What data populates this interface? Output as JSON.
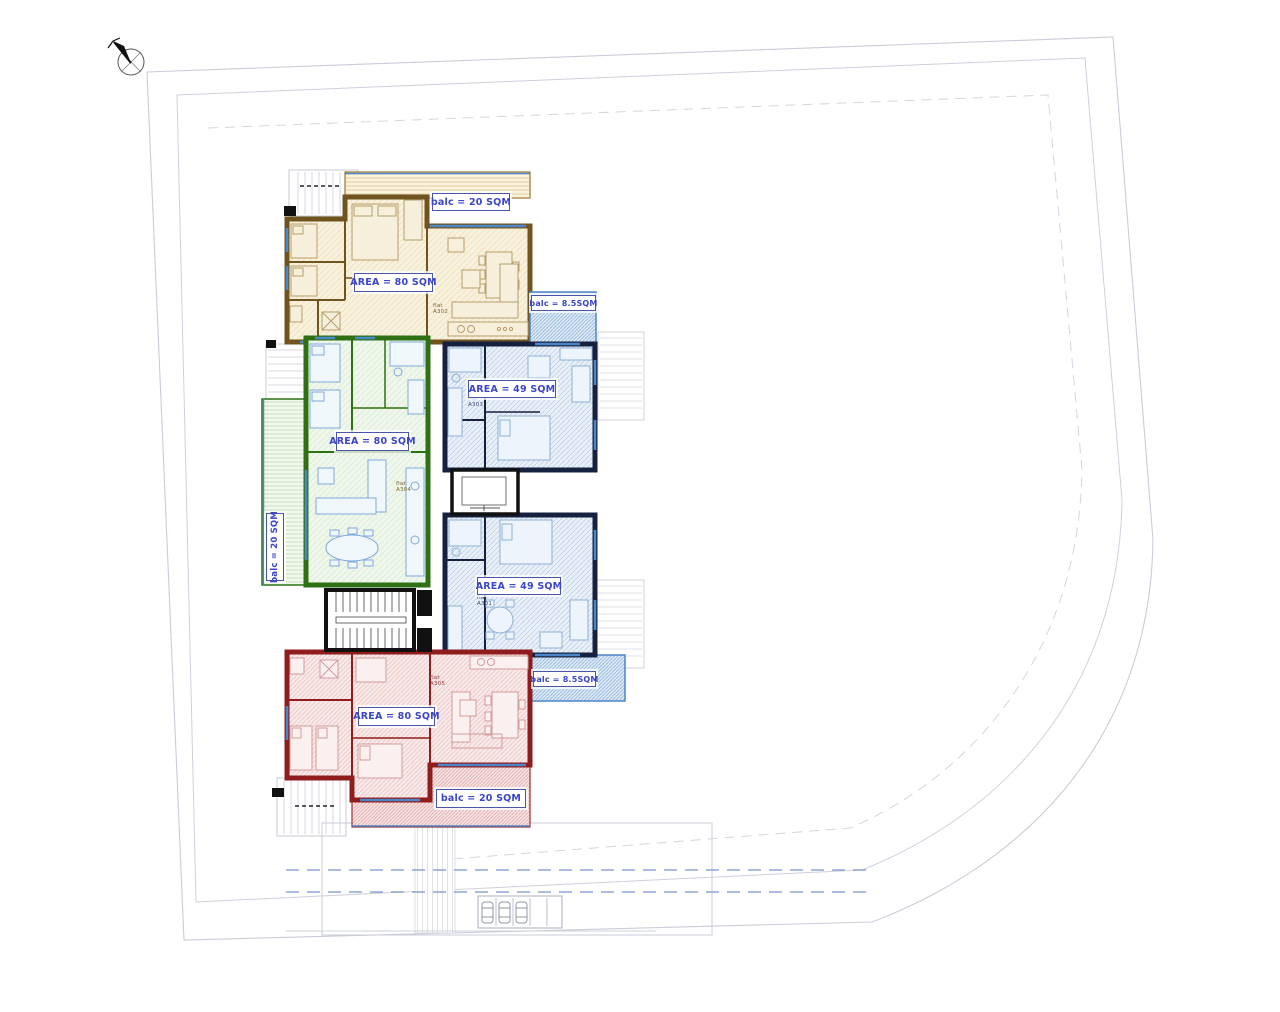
{
  "units": [
    {
      "id": "A302",
      "flat": "flat\nA302",
      "area_label": "AREA = 80 SQM",
      "balc_label": "balc = 20 SQM",
      "wall_color": "#6f5420"
    },
    {
      "id": "A303",
      "flat": "flat\nA303",
      "area_label": "AREA = 49 SQM",
      "balc_label": "balc = 8.5SQM",
      "wall_color": "#16213f"
    },
    {
      "id": "A304",
      "flat": "flat\nA304",
      "area_label": "AREA = 80 SQM",
      "balc_label": "balc = 20 SQM",
      "wall_color": "#2e7013"
    },
    {
      "id": "A301",
      "flat": "flat\nA301",
      "area_label": "AREA = 49 SQM",
      "balc_label": "balc = 8.5SQM",
      "wall_color": "#16213f"
    },
    {
      "id": "A305",
      "flat": "flat\nA305",
      "area_label": "AREA = 80 SQM",
      "balc_label": "balc = 20 SQM",
      "wall_color": "#8f1d1d"
    }
  ],
  "colors": {
    "label_text": "#3b45c8",
    "label_border": "#4a55a8",
    "balcony_edge": "#4a86c8",
    "site_line": "#c9cdd8",
    "dashed_line": "#7c93c9"
  }
}
